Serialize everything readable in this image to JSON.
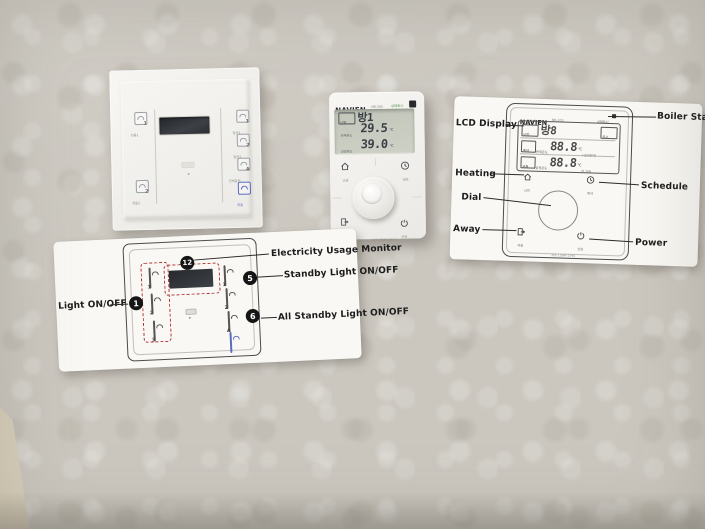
{
  "wall": {
    "wallpaper_base": "#cbc7bf",
    "corner_strip": "#d9cfbc"
  },
  "colors": {
    "red_dashed": "#b03030",
    "away_blue": "#5a6cc0",
    "navien_green": "#3e8e41"
  },
  "smart_switch": {
    "title": "SMART SWITCH",
    "left_buttons": [
      {
        "num": "1",
        "label": "전등1"
      },
      {
        "num": "2",
        "label": "전등2"
      }
    ],
    "right_buttons": [
      {
        "num": "1",
        "label": "절전1"
      },
      {
        "num": "2",
        "label": "절전2"
      },
      {
        "num": "A",
        "label": "전체절전"
      },
      {
        "num": "",
        "label": "외출"
      }
    ]
  },
  "thermostat": {
    "brand": "NAVIEN",
    "model": "NR-20S",
    "status_tag": "상태표시",
    "lcd": {
      "mode_tag": "난방",
      "zone": "방1",
      "current_label": "현재온도",
      "current_value": "29.5",
      "set_label": "설정온도",
      "set_value": "39.0",
      "unit": "℃"
    },
    "buttons": {
      "heating": "난방",
      "schedule": "예약",
      "away": "외출",
      "power": "전원"
    },
    "service_text": "A/S 1588-1144"
  },
  "boiler_card": {
    "callouts": {
      "lcd": "LCD Display",
      "status": "Boiler Status",
      "heating": "Heating",
      "schedule": "Schedule",
      "dial": "Dial",
      "away": "Away",
      "power": "Power"
    },
    "drawing": {
      "brand": "NAVIEN",
      "model": "NR-20S",
      "status_tag": "상태표시",
      "lcd": {
        "mode_tag": "난방",
        "zone": "방8",
        "dhw_tag": "온수",
        "reserve_tag": "예약",
        "away_tag": "외출",
        "current_label": "현재온도",
        "current_value": "88.8",
        "set_label": "설정온도",
        "set_value": "88.8",
        "unit": "℃",
        "time_suffix": "시간(예약)",
        "minute_suffix": "분 가동"
      },
      "buttons": {
        "heating": "난방",
        "schedule": "예약",
        "away": "외출",
        "power": "전원"
      },
      "service_text": "A/S 1588-1144"
    }
  },
  "switch_card": {
    "drawing": {
      "title": "SMART SWITCH"
    },
    "callouts": {
      "light": {
        "num": "1",
        "label": "Light ON/OFF"
      },
      "monitor": {
        "num": "12",
        "label": "Electricity Usage Monitor"
      },
      "standby": {
        "num": "5",
        "label": "Standby Light ON/OFF"
      },
      "standby_all": {
        "num": "6",
        "label": "All Standby Light ON/OFF"
      }
    }
  }
}
